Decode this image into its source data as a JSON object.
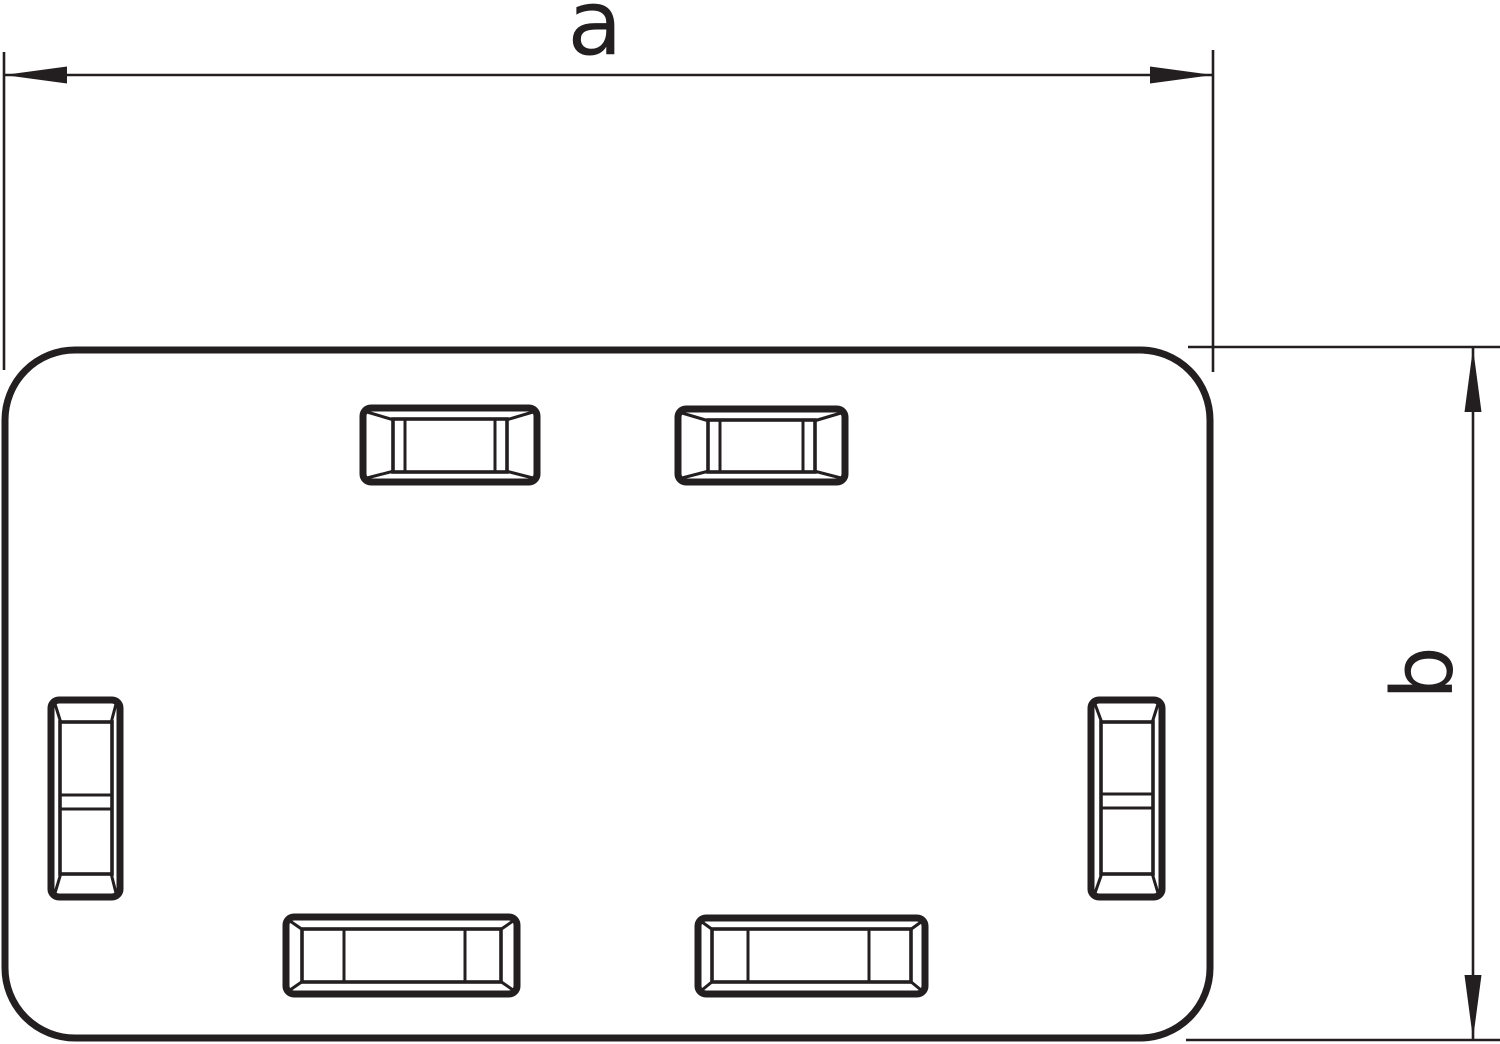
{
  "meta": {
    "description": "Technical line drawing: rectangular end piece with six beveled latch openings and two dimension callouts",
    "background_color": "#ffffff",
    "line_color": "#231f20"
  },
  "dimensions": {
    "width": {
      "label": "a"
    },
    "height": {
      "label": "b"
    }
  }
}
